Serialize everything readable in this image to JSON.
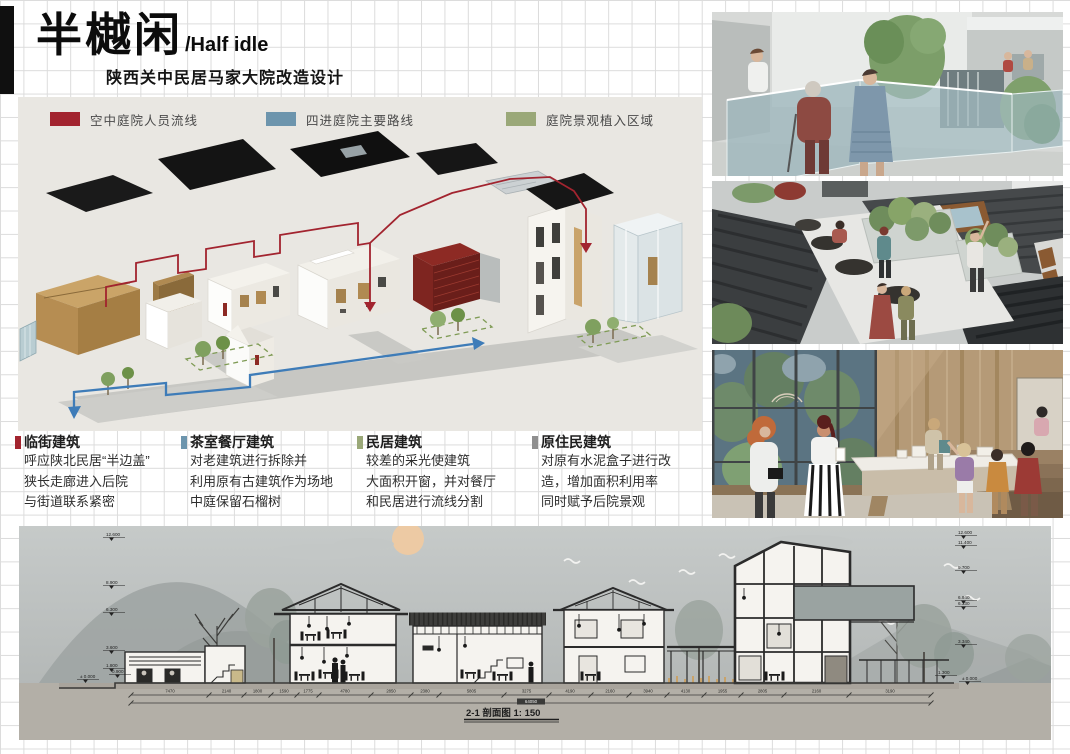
{
  "header": {
    "title_cn": "半樾闲",
    "title_en": "/Half idle",
    "subtitle": "陕西关中民居马家大院改造设计"
  },
  "legend": {
    "items": [
      {
        "label": "空中庭院人员流线",
        "color": "#a2242f"
      },
      {
        "label": "四进庭院主要路线",
        "color": "#6d95ad"
      },
      {
        "label": "庭院景观植入区域",
        "color": "#9aa878"
      }
    ]
  },
  "annotations": {
    "blocks": [
      {
        "color": "#a2242f",
        "title": "临街建筑",
        "lines": [
          "呼应陕北民居“半边盖”",
          "狭长走廊进入后院",
          "与街道联系紧密"
        ]
      },
      {
        "color": "#6d95ad",
        "title": "茶室餐厅建筑",
        "lines": [
          "对老建筑进行拆除并",
          "利用原有古建筑作为场地",
          "中庭保留石榴树"
        ]
      },
      {
        "color": "#9aa878",
        "title": "民居建筑",
        "lines": [
          "较差的采光使建筑",
          "大面积开窗，并对餐厅",
          "和民居进行流线分割"
        ]
      },
      {
        "color": "#8f8f8f",
        "title": "原住民建筑",
        "lines": [
          "对原有水泥盒子进行改",
          "造，增加面积利用率",
          "同时赋予后院景观"
        ]
      }
    ]
  },
  "section": {
    "caption": "2-1 剖面图",
    "scale": "1: 150",
    "left_levels": [
      "12.600",
      "8.900",
      "6.300",
      "3.600",
      "1.800",
      "0.900",
      "± 0.000"
    ],
    "right_levels": [
      "12.600",
      "11.400",
      "9.700",
      "6.940",
      "6.330",
      "3.340",
      "1.300",
      "± 0.000"
    ],
    "dimensions": [
      "7470",
      "2140",
      "1800",
      "1590",
      "1775",
      "4780",
      "2850",
      "2380",
      "5805",
      "3275",
      "4190",
      "2160",
      "3940",
      "4130",
      "1955",
      "2805",
      "2160",
      "3190"
    ],
    "total_dimension": "64050"
  },
  "renders": [
    {
      "name": "sky-courtyard-render"
    },
    {
      "name": "roof-terrace-render"
    },
    {
      "name": "tea-house-interior-render"
    }
  ]
}
